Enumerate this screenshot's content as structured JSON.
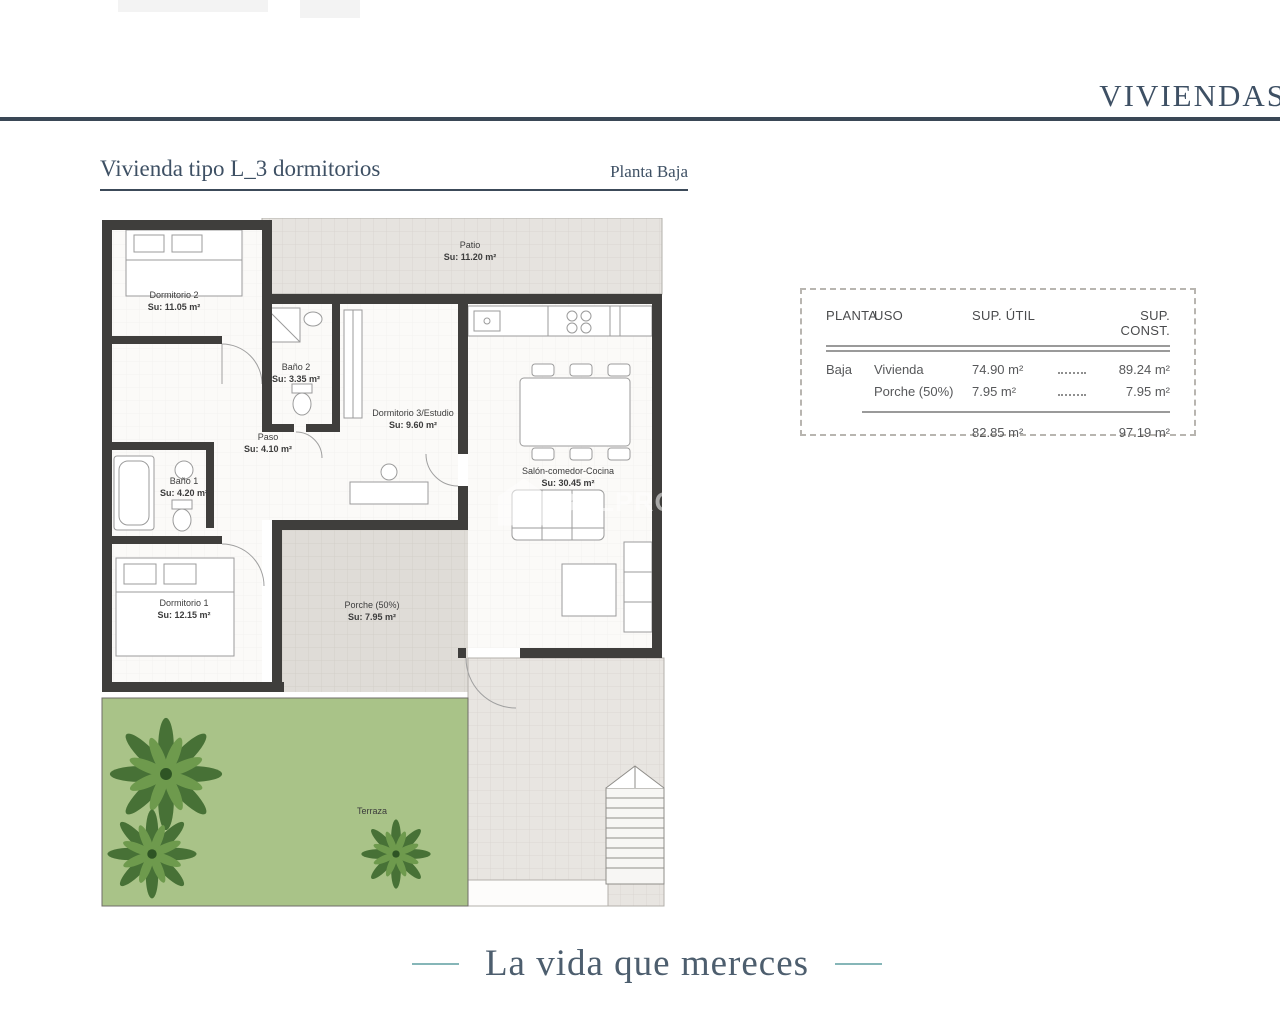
{
  "header": {
    "brand": "VIVIENDAS"
  },
  "plan_header": {
    "title": "Vivienda tipo L_3 dormitorios",
    "floor": "Planta Baja"
  },
  "rooms": {
    "patio": {
      "name": "Patio",
      "area": "Su: 11.20 m²"
    },
    "dormitorio2": {
      "name": "Dormitorio 2",
      "area": "Su: 11.05 m²"
    },
    "bano2": {
      "name": "Baño 2",
      "area": "Su: 3.35 m²"
    },
    "dormitorio3": {
      "name": "Dormitorio 3/Estudio",
      "area": "Su: 9.60 m²"
    },
    "paso": {
      "name": "Paso",
      "area": "Su: 4.10 m²"
    },
    "bano1": {
      "name": "Baño 1",
      "area": "Su: 4.20 m²"
    },
    "salon": {
      "name": "Salón-comedor-Cocina",
      "area": "Su: 30.45 m²"
    },
    "dormitorio1": {
      "name": "Dormitorio 1",
      "area": "Su: 12.15 m²"
    },
    "porche": {
      "name": "Porche (50%)",
      "area": "Su: 7.95 m²"
    },
    "terraza": {
      "name": "Terraza",
      "area": ""
    }
  },
  "watermark": {
    "text": "B&LPROM"
  },
  "table": {
    "headers": {
      "planta": "PLANTA",
      "uso": "USO",
      "sup_util": "SUP. ÚTIL",
      "sup_const": "SUP. CONST."
    },
    "rows": [
      {
        "planta": "Baja",
        "uso": "Vivienda",
        "sup_util": "74.90 m²",
        "sup_const": "89.24 m²"
      },
      {
        "planta": "",
        "uso": "Porche (50%)",
        "sup_util": "7.95 m²",
        "sup_const": "7.95 m²"
      }
    ],
    "totals": {
      "sup_util": "82.85 m²",
      "sup_const": "97.19 m²"
    }
  },
  "footer": {
    "slogan": "La vida que mereces"
  },
  "colors": {
    "accent": "#3e5064",
    "teal": "#86b6b8",
    "wall": "#3f3e3c",
    "terrace": "#a9c388",
    "palm": "#477136"
  }
}
